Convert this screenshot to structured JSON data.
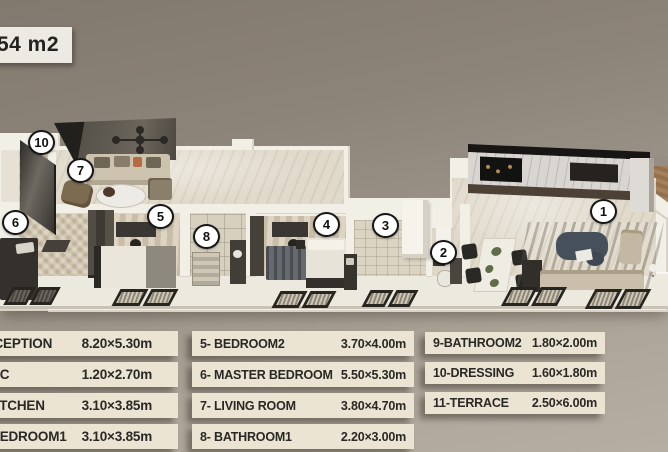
{
  "area_badge": {
    "text": "54 m2"
  },
  "floorplan": {
    "markers": [
      "1",
      "2",
      "3",
      "4",
      "5",
      "6",
      "7",
      "8",
      "10"
    ]
  },
  "legend": {
    "columns": [
      {
        "rows": [
          {
            "label": "1- RECEPTION",
            "dims": "8.20×5.30m"
          },
          {
            "label": "2- WC",
            "dims": "1.20×2.70m"
          },
          {
            "label": "3- KITCHEN",
            "dims": "3.10×3.85m"
          },
          {
            "label": "4- BEDROOM1",
            "dims": "3.10×3.85m"
          }
        ]
      },
      {
        "rows": [
          {
            "label": "5- BEDROOM2",
            "dims": "3.70×4.00m"
          },
          {
            "label": "6- MASTER BEDROOM",
            "dims": "5.50×5.30m"
          },
          {
            "label": "7- LIVING ROOM",
            "dims": "3.80×4.70m"
          },
          {
            "label": "8- BATHROOM1",
            "dims": "2.20×3.00m"
          }
        ]
      },
      {
        "rows": [
          {
            "label": "9-BATHROOM2",
            "dims": "1.80×2.00m"
          },
          {
            "label": "10-DRESSING",
            "dims": "1.60×1.80m"
          },
          {
            "label": "11-TERRACE",
            "dims": "2.50×6.00m"
          }
        ]
      }
    ]
  },
  "colors": {
    "background_top": "#81786e",
    "background_bottom": "#b6aea2",
    "wall_white": "#f2efe7",
    "legend_box": "#ebe4d3",
    "legend_text": "#292826",
    "marker_border": "#161616",
    "badge_bg": "#edeae4"
  }
}
